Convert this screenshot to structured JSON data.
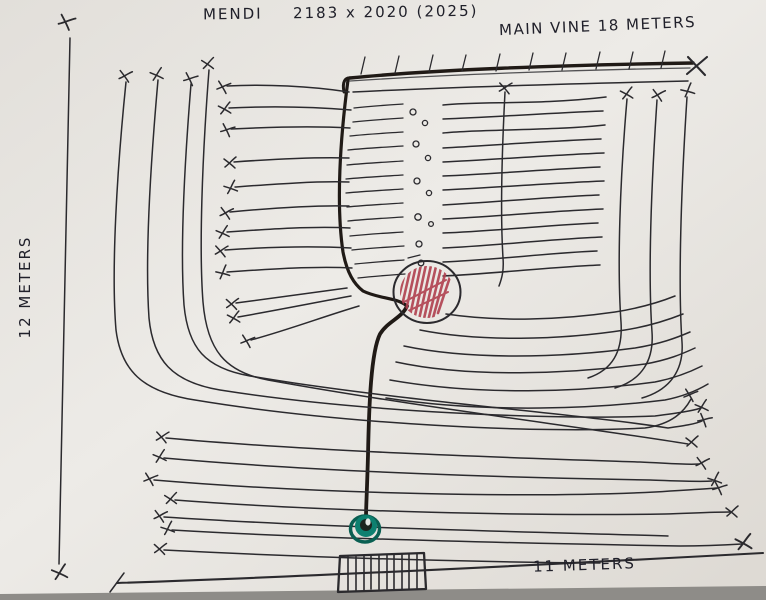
{
  "header": {
    "title_name": "MENDI",
    "title_dimensions": "2183 x 2020 (2025)",
    "main_vine_label": "MAIN VINE 18 METERS"
  },
  "measurements": {
    "left_side": "12 METERS",
    "bottom_side": "11 METERS"
  },
  "colors": {
    "ink": "#2b2a2e",
    "vine": "#201a16",
    "red_hatch": "#b0404e",
    "green_marker": "#0e8070",
    "green_dark": "#0a5f52",
    "paper": "#e9e6e1",
    "table": "#8e8c88",
    "text": "#20202a"
  }
}
